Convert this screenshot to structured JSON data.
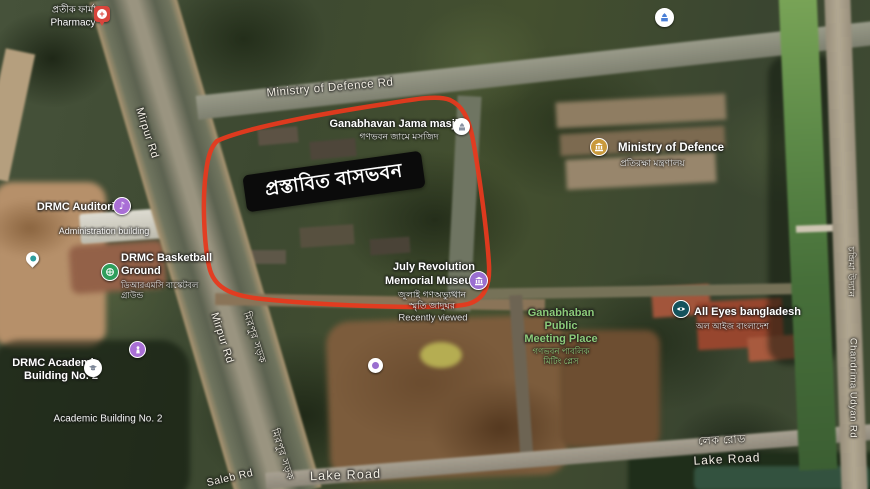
{
  "colors": {
    "annotation_red": "#e6391e",
    "annotation_box_bg": "#0b0b0b",
    "annotation_box_text": "#ffffff",
    "place_label": "#ffffff",
    "road_label": "#f3efe4",
    "park_label": "#8ccb7a",
    "poi_purple": "#a96fd6",
    "poi_green": "#2f9e5b",
    "poi_gold": "#c9993b",
    "poi_teal_dark": "#14525c",
    "poi_blue": "#4a7fd6",
    "pharmacy_red": "#d8453c"
  },
  "annotation": {
    "proposed_area_label": "প্রস্তাবিত বাসভবন"
  },
  "places": {
    "pharmacy": {
      "name_bn": "প্রতীক ফার্মা",
      "name_en": "Pharmacy"
    },
    "ganabhavan_jama_masjid": {
      "name_en": "Ganabhavan Jama masjid",
      "name_bn": "গণভবন জামে মসজিদ"
    },
    "ministry_of_defence": {
      "name_en": "Ministry of Defence",
      "name_bn": "প্রতিরক্ষা মন্ত্রণালয়"
    },
    "drmc_auditorium": {
      "name_en": "DRMC Auditorium"
    },
    "administration_building": {
      "name_en": "Administration building"
    },
    "drmc_basketball_ground": {
      "line1": "DRMC Basketball",
      "line2": "Ground",
      "bn1": "ডিআরএমসি বাস্কেটবল",
      "bn2": "গ্রাউন্ড"
    },
    "july_revolution_museum": {
      "line1": "July Revolution",
      "line2": "Memorial Museum",
      "bn1": "জুলাই গণঅভ্যুত্থান",
      "bn2": "স্মৃতি জাদুঘর",
      "status": "Recently viewed"
    },
    "ganabhaban_public_meeting_place": {
      "line1": "Ganabhaban",
      "line2": "Public",
      "line3": "Meeting Place",
      "bn1": "গণভবন পাবলিক",
      "bn2": "মিটিং প্লেস"
    },
    "all_eyes_bangladesh": {
      "name_en": "All Eyes bangladesh",
      "name_bn": "অল আইজ বাংলাদেশ"
    },
    "drmc_academic_building": {
      "line1": "DRMC Academic",
      "line2": "Building No. 2"
    },
    "academic_building_2": {
      "name_en": "Academic Building No. 2"
    }
  },
  "roads": {
    "ministry_of_defence_rd": "Ministry of Defence Rd",
    "mirpur_rd": "Mirpur Rd",
    "mirpur_rd_bn": "মিরপুর সড়ক",
    "lake_road": "Lake Road",
    "lake_road_bn": "লেক রোড",
    "saleb_rd": "Saleb Rd",
    "chandrima_udyan_rd": "Chandrima Udyan Rd",
    "chandrima_udyan_bn": "চন্দ্রিমা উদ্যান"
  }
}
